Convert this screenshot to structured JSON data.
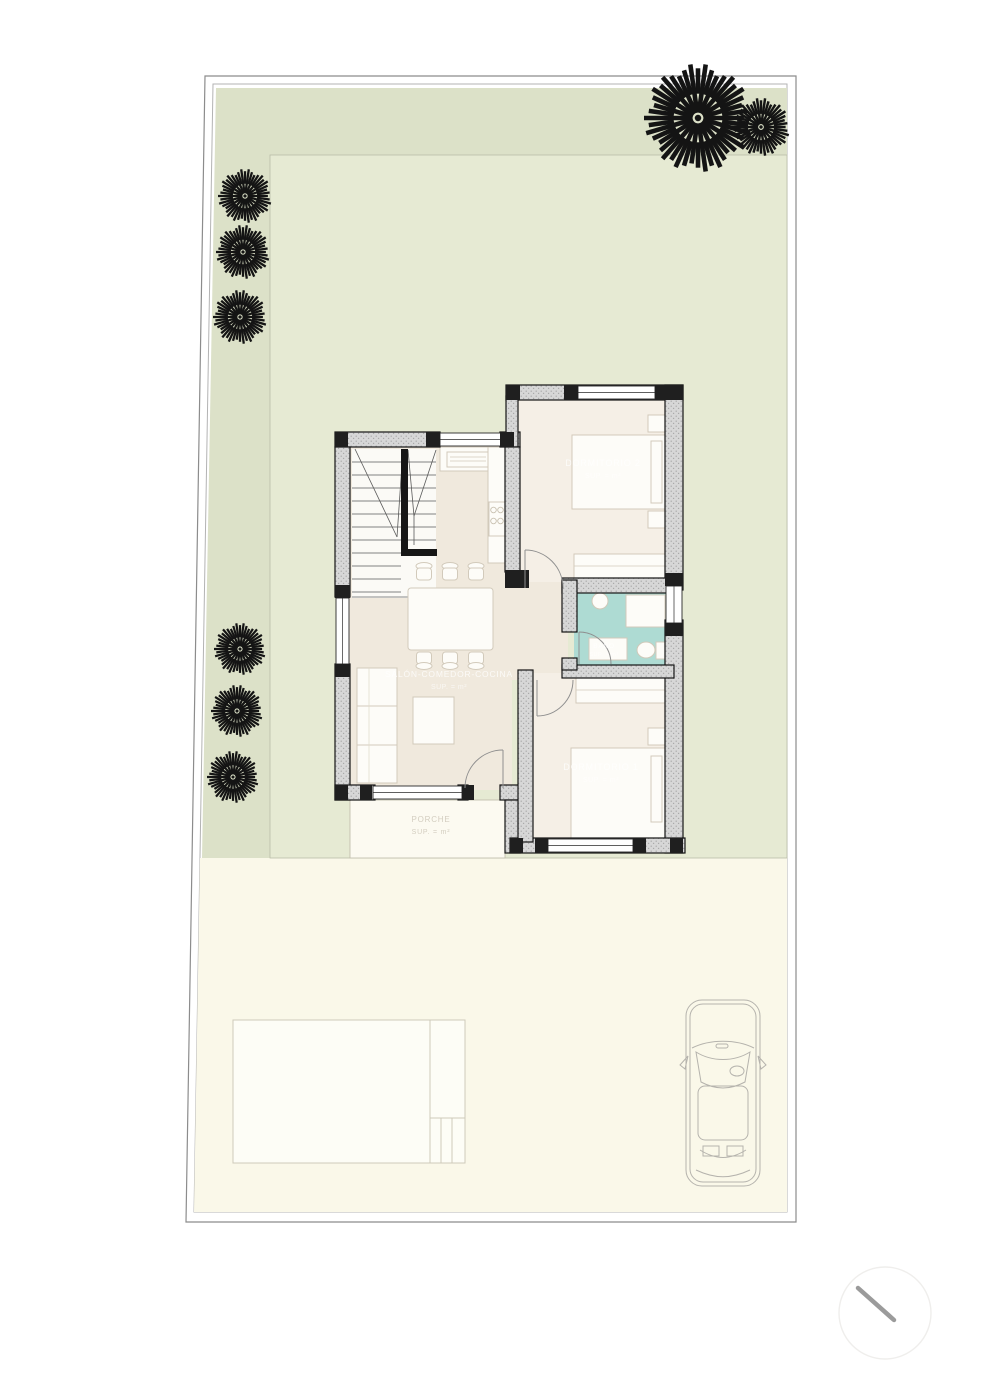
{
  "colors": {
    "page": "#ffffff",
    "garden_dark": "#dce1c8",
    "garden_light": "#e6ead3",
    "paving": "#faf8e9",
    "floor_main": "#f0e9dd",
    "floor_bedroom": "#f5efe6",
    "floor_bath": "#aedbd3",
    "pool_fill": "#fdfdf6",
    "tree": "#141414",
    "north_line": "#9b9b9b"
  },
  "site": {
    "trees": [
      {
        "cx": 698,
        "cy": 118,
        "r": 54
      },
      {
        "cx": 761,
        "cy": 127,
        "r": 29
      },
      {
        "cx": 245,
        "cy": 196,
        "r": 27
      },
      {
        "cx": 243,
        "cy": 252,
        "r": 27
      },
      {
        "cx": 240,
        "cy": 317,
        "r": 27
      },
      {
        "cx": 240,
        "cy": 649,
        "r": 26
      },
      {
        "cx": 237,
        "cy": 711,
        "r": 26
      },
      {
        "cx": 233,
        "cy": 777,
        "r": 26
      }
    ]
  },
  "rooms": {
    "living": {
      "name": "SALÓN-COMEDOR-COCINA",
      "area": "SUP. =      m²"
    },
    "bedroom_2": {
      "name": "DORMITORIO 2",
      "area": "SUP. =      m²"
    },
    "bedroom_1": {
      "name": "DORMITORIO 1",
      "area": "SUP. =      m²"
    },
    "bathroom": {
      "name": "BAÑO",
      "area": "SUP. =   m²"
    },
    "porch": {
      "name": "PORCHE",
      "area": "SUP. =    m²"
    }
  }
}
